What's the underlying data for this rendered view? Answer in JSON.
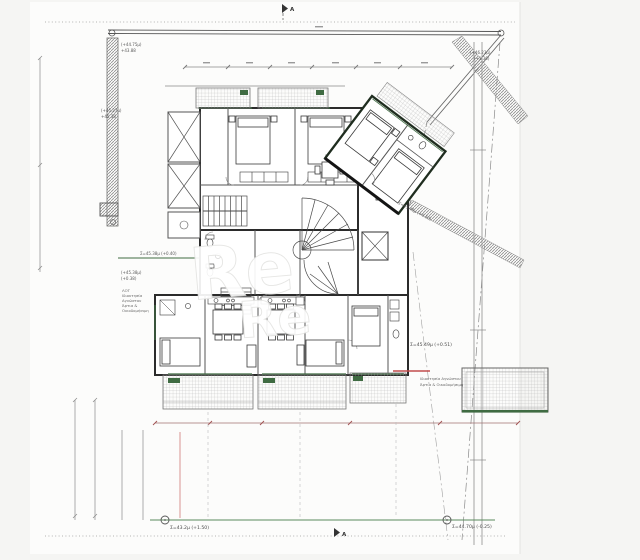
{
  "page": {
    "background": "#f5f5f3",
    "paper": "#fcfcfb"
  },
  "drawing": {
    "type": "architectural-floor-plan",
    "section_markers": {
      "top": "A",
      "bottom": "A"
    },
    "watermark": {
      "text": "Re"
    },
    "colors": {
      "walls": "#2b2b2b",
      "partitions": "#555555",
      "green_accent": "#3f6b42",
      "site_line": "#5a8a5c",
      "dimension": "#8a8a8a",
      "red_accent": "#c24d4d",
      "hatch": "#9a9a9a"
    },
    "annotations": {
      "wall_top": {
        "line1": "(+44.75μ)",
        "line2": "+43.88"
      },
      "wall_mid": {
        "line1": "(+45.27μ)",
        "line2": "+45.38"
      },
      "top_right": {
        "line1": "(+46.23μ)",
        "line2": "(+1.36)"
      },
      "edge_top_left": "Σ=45.38μ (+0.40)",
      "left_level": {
        "line1": "(+45.38μ)",
        "line2": "(+0.38)"
      },
      "parcel_left": {
        "line1": "ΛΟΤ",
        "line2": "Ιδιοκτησία",
        "line3": "Αγνώστου",
        "line4": "Άρτια &",
        "line5": "Οικοδομήσιμη"
      },
      "right_level": "Σ=45.49μ (+0.51)",
      "parcel_right": {
        "line1": "Ιδιοκτησία Αγνώστου",
        "line2": "Άρτια & Οικοδομήσιμη"
      },
      "diagonal_level": "Σ=45.48μ (+0.50)",
      "bottom_left_level": "Σ=43.2μ (+1.50)",
      "bottom_right_level": "Σ=44.70μ (-0.25)"
    }
  }
}
